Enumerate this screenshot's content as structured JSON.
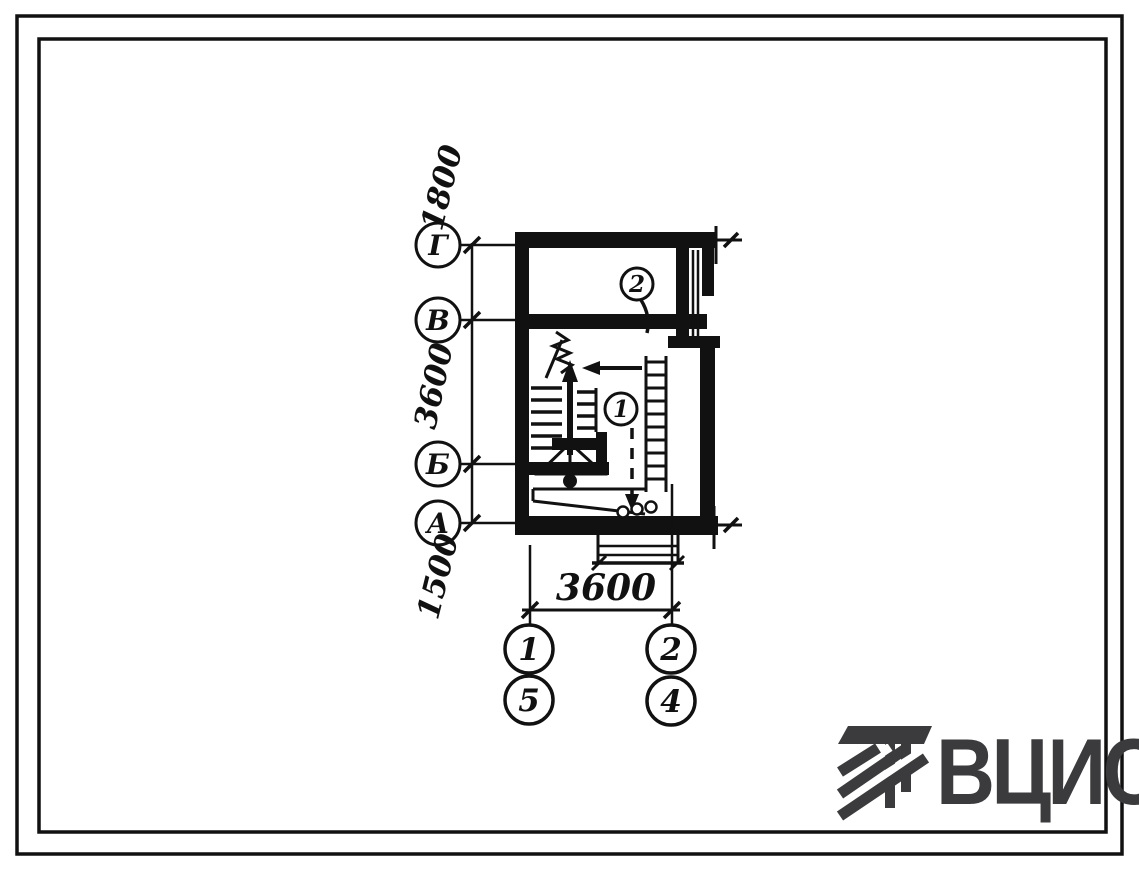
{
  "axes": {
    "rows": [
      {
        "label": "Г"
      },
      {
        "label": "В"
      },
      {
        "label": "Б"
      },
      {
        "label": "А"
      }
    ],
    "row_spans": [
      {
        "value": "1800"
      },
      {
        "value": "3600"
      },
      {
        "value": "1500"
      }
    ],
    "columns": [
      {
        "top": "1",
        "bottom": "5"
      },
      {
        "top": "2",
        "bottom": "4"
      }
    ],
    "column_span": "3600"
  },
  "callouts": [
    {
      "label": "2"
    },
    {
      "label": "1"
    }
  ],
  "logo": {
    "text": "ВЦИС",
    "color": "#3b3b3d"
  },
  "colors": {
    "paper": "#ffffff",
    "ink": "#111111"
  }
}
